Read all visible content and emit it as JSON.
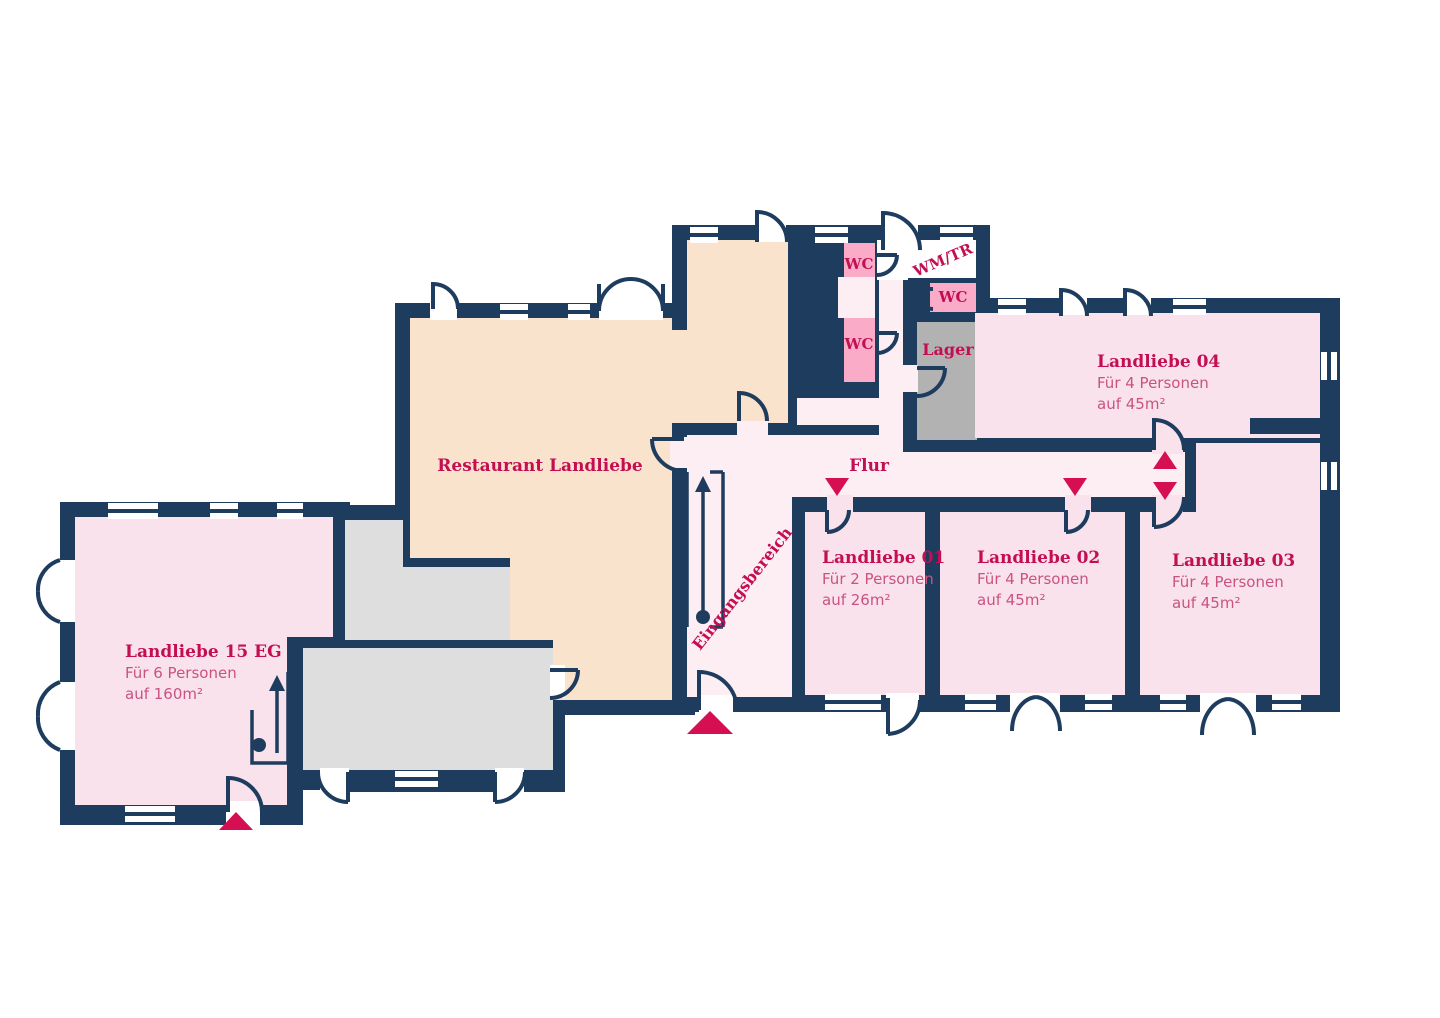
{
  "title": "Landliebe Grundriss",
  "colors": {
    "wall": "#1e3c5e",
    "room_pink": "#fae2ec",
    "hall_pink": "#fdeef4",
    "wc_pink": "#f9abc7",
    "beige": "#fae3cd",
    "storage_gray": "#b2b2b2",
    "utility_gray": "#dedede",
    "red": "#d60f53",
    "title_red": "#c40e52",
    "sub_red": "#c95380"
  },
  "rooms": {
    "restaurant": {
      "title": "Restaurant Landliebe"
    },
    "landliebe_15": {
      "title": "Landliebe 15 EG",
      "capacity": "Für 6 Personen",
      "area": "auf 160m²"
    },
    "landliebe_01": {
      "title": "Landliebe 01",
      "capacity": "Für 2 Personen",
      "area": "auf 26m²"
    },
    "landliebe_02": {
      "title": "Landliebe 02",
      "capacity": "Für 4 Personen",
      "area": "auf 45m²"
    },
    "landliebe_03": {
      "title": "Landliebe 03",
      "capacity": "Für 4 Personen",
      "area": "auf 45m²"
    },
    "landliebe_04": {
      "title": "Landliebe 04",
      "capacity": "Für 4 Personen",
      "area": "auf 45m²"
    },
    "wc_1": {
      "title": "WC"
    },
    "wc_2": {
      "title": "WC"
    },
    "wc_3": {
      "title": "WC"
    },
    "wm_tr": {
      "title": "WM/TR"
    },
    "lager": {
      "title": "Lager"
    },
    "flur": {
      "title": "Flur"
    },
    "eingangsbereich": {
      "title": "Eingangsbereich"
    }
  }
}
